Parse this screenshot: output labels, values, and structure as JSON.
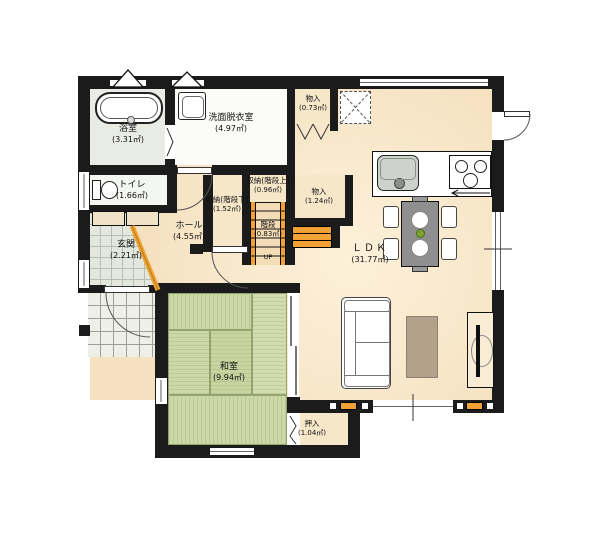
{
  "plan": {
    "type": "japanese-house-floor-plan",
    "colors": {
      "wall": "#1b1b1b",
      "wood_floor": "#f5e1c0",
      "tatami": "#ccd8a5",
      "closet": "#f6e7c9",
      "accent_orange": "#f0a232",
      "entrance_tile": "#e3e7dd",
      "porch_tile": "#edefe8",
      "bath_floor": "#e9ece6"
    }
  },
  "rooms": {
    "bathroom": {
      "name": "浴室",
      "area": "(3.31㎡)"
    },
    "washroom": {
      "name": "洗面脱衣室",
      "area": "(4.97㎡)"
    },
    "toilet": {
      "name": "トイレ",
      "area": "(1.66㎡)"
    },
    "entrance": {
      "name": "玄関",
      "area": "(2.21㎡)"
    },
    "hall": {
      "name": "ホール",
      "area": "(4.55㎡)"
    },
    "storage_under_stairs": {
      "name": "収納(階段下)",
      "area": "(1.52㎡)"
    },
    "storage_above_stairs": {
      "name": "収納(階段上)",
      "area": "(0.96㎡)"
    },
    "stairs": {
      "name": "階段",
      "area": "(0.83㎡)",
      "up": "UP"
    },
    "closet_upper": {
      "name": "物入",
      "area": "(0.73㎡)"
    },
    "closet_middle": {
      "name": "物入",
      "area": "(1.24㎡)"
    },
    "ldk": {
      "name": "ＬＤＫ",
      "area": "(31.77㎡)"
    },
    "japanese_room": {
      "name": "和室",
      "area": "(9.94㎡)"
    },
    "oshiire": {
      "name": "押入",
      "area": "(1.04㎡)"
    }
  }
}
